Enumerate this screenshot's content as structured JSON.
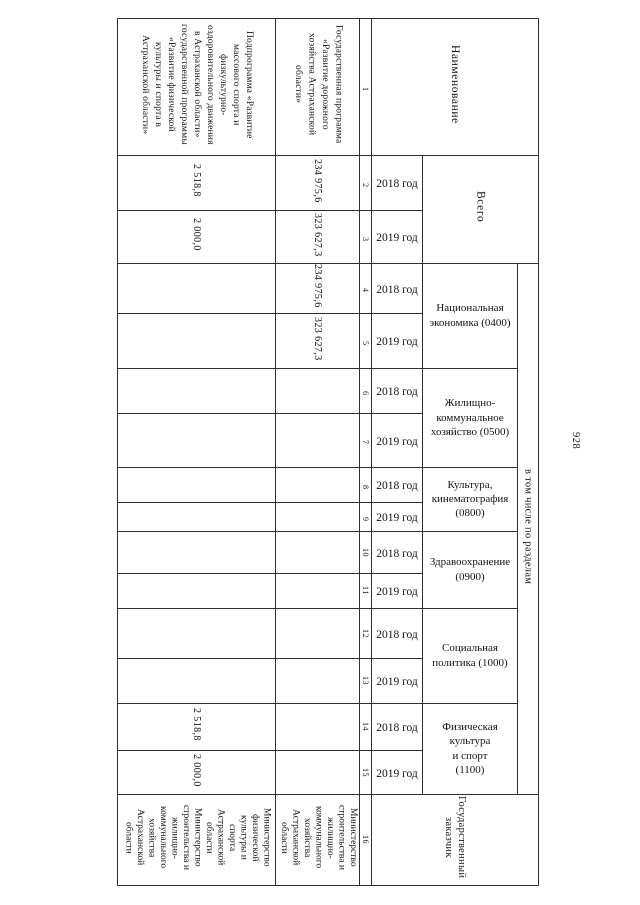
{
  "page": {
    "number": "928"
  },
  "table": {
    "headers": {
      "name_col": "Наименование",
      "total": "Всего",
      "sections_group": "в том числе по разделам",
      "customer": "Государственный\nзаказчик",
      "year_2018": "2018 год",
      "year_2019": "2019 год"
    },
    "col_numbers": [
      "1",
      "2",
      "3",
      "4",
      "5",
      "6",
      "7",
      "8",
      "9",
      "10",
      "11",
      "12",
      "13",
      "14",
      "15",
      "16"
    ],
    "sections": [
      {
        "label": "Национальная\nэкономика (0400)"
      },
      {
        "label": "Жилищно-\nкоммунальное\nхозяйство (0500)"
      },
      {
        "label": "Культура,\nкинематография\n(0800)"
      },
      {
        "label": "Здравоохранение\n(0900)"
      },
      {
        "label": "Социальная\nполитика (1000)"
      },
      {
        "label": "Физическая\nкультура\nи спорт\n(1100)"
      }
    ],
    "program": {
      "name": "Государственная программа\n«Развитие дорожного\nхозяйства Астраханской\nобласти»",
      "total_2018": "234 975,6",
      "total_2019": "323 627,3",
      "s0400_2018": "234 975,6",
      "s0400_2019": "323 627,3",
      "ministry": "Министерство\nстроительства и\nжилищно-\nкоммунального\nхозяйства\nАстраханской\nобласти"
    },
    "subprogram": {
      "name": "Подпрограмма «Развитие\nмассового спорта и\nфизкультурно-\nоздоровительного движения\nв Астраханской области»\nгосударственной программы\n«Развитие физической\nкультуры и спорта в\nАстраханской области»",
      "total_2018": "2 518,8",
      "total_2019": "2 000,0",
      "s1100_2018": "2 518,8",
      "s1100_2019": "2 000,0",
      "ministries": [
        "Министерство\nфизической\nкультуры и\nспорта\nАстраханской\nобласти",
        "Министерство\nстроительства и\nжилищно-\nкоммунального\nхозяйства\nАстраханской\nобласти"
      ]
    }
  }
}
